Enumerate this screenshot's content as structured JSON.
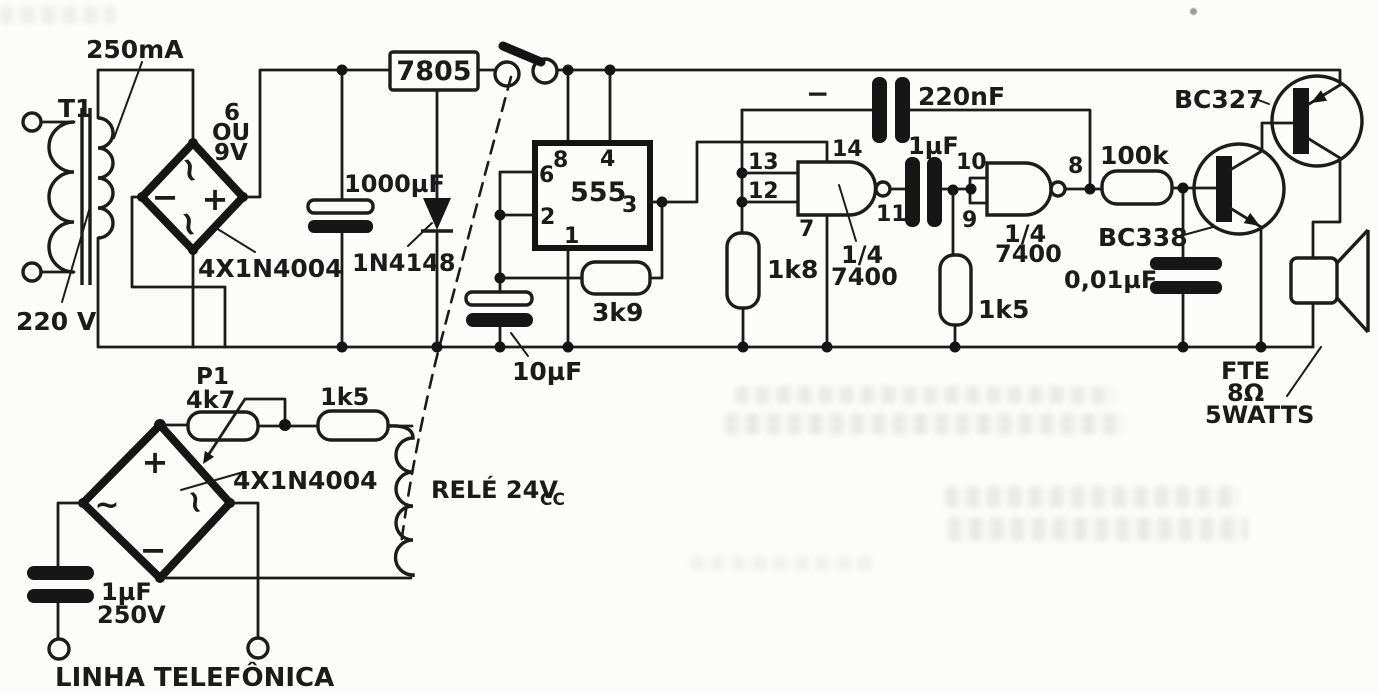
{
  "schematic": {
    "power": {
      "transformer": {
        "name": "T1",
        "current_rating": "250mA",
        "primary_voltage": "220 V",
        "sec1": "6",
        "sec2": "OU",
        "sec3": "9V"
      },
      "bridge": {
        "label": "4X1N4004",
        "plus": "+",
        "minus": "−",
        "ac": "~"
      },
      "regulator": {
        "label": "7805"
      },
      "filter_capacitor": {
        "label": "1000µF"
      },
      "diode": {
        "label": "1N4148"
      }
    },
    "oscillator": {
      "timer": {
        "label": "555",
        "pin8": "8",
        "pin4": "4",
        "pin6": "6",
        "pin2": "2",
        "pin3": "3",
        "pin1": "1"
      },
      "resistor_3k9": {
        "label": "3k9"
      },
      "capacitor_10uf": {
        "label": "10µF"
      }
    },
    "gates": {
      "gate1": {
        "pin13": "13",
        "pin12": "12",
        "pin14": "14",
        "pin7": "7",
        "pin11": "11",
        "fraction": "1/4",
        "ic": "7400"
      },
      "gate2": {
        "pin10": "10",
        "pin9": "9",
        "pin8": "8",
        "fraction": "1/4",
        "ic": "7400"
      },
      "feedback_capacitor": {
        "label": "220nF",
        "polarity": "−"
      },
      "coupling_capacitor": {
        "label": "1µF"
      },
      "resistor_1k8": {
        "label": "1k8"
      },
      "resistor_1k5": {
        "label": "1k5"
      }
    },
    "amplifier": {
      "resistor_100k": {
        "label": "100k"
      },
      "capacitor_001uf": {
        "label": "0,01µF"
      },
      "npn_transistor": {
        "label": "BC338"
      },
      "pnp_transistor": {
        "label": "BC327"
      },
      "speaker": {
        "line1": "FTE",
        "line2": "8Ω",
        "line3": "5WATTS"
      }
    },
    "line_interface": {
      "bridge": {
        "label": "4X1N4004",
        "plus": "+",
        "minus": "−",
        "ac": "~"
      },
      "potentiometer": {
        "name": "P1",
        "value": "4k7"
      },
      "resistor_1k5": {
        "label": "1k5"
      },
      "relay": {
        "label": "RELÉ 24V",
        "subscript": "CC"
      },
      "line_capacitor": {
        "value": "1µF",
        "voltage": "250V"
      },
      "line_label": "LINHA TELEFÔNICA"
    }
  }
}
